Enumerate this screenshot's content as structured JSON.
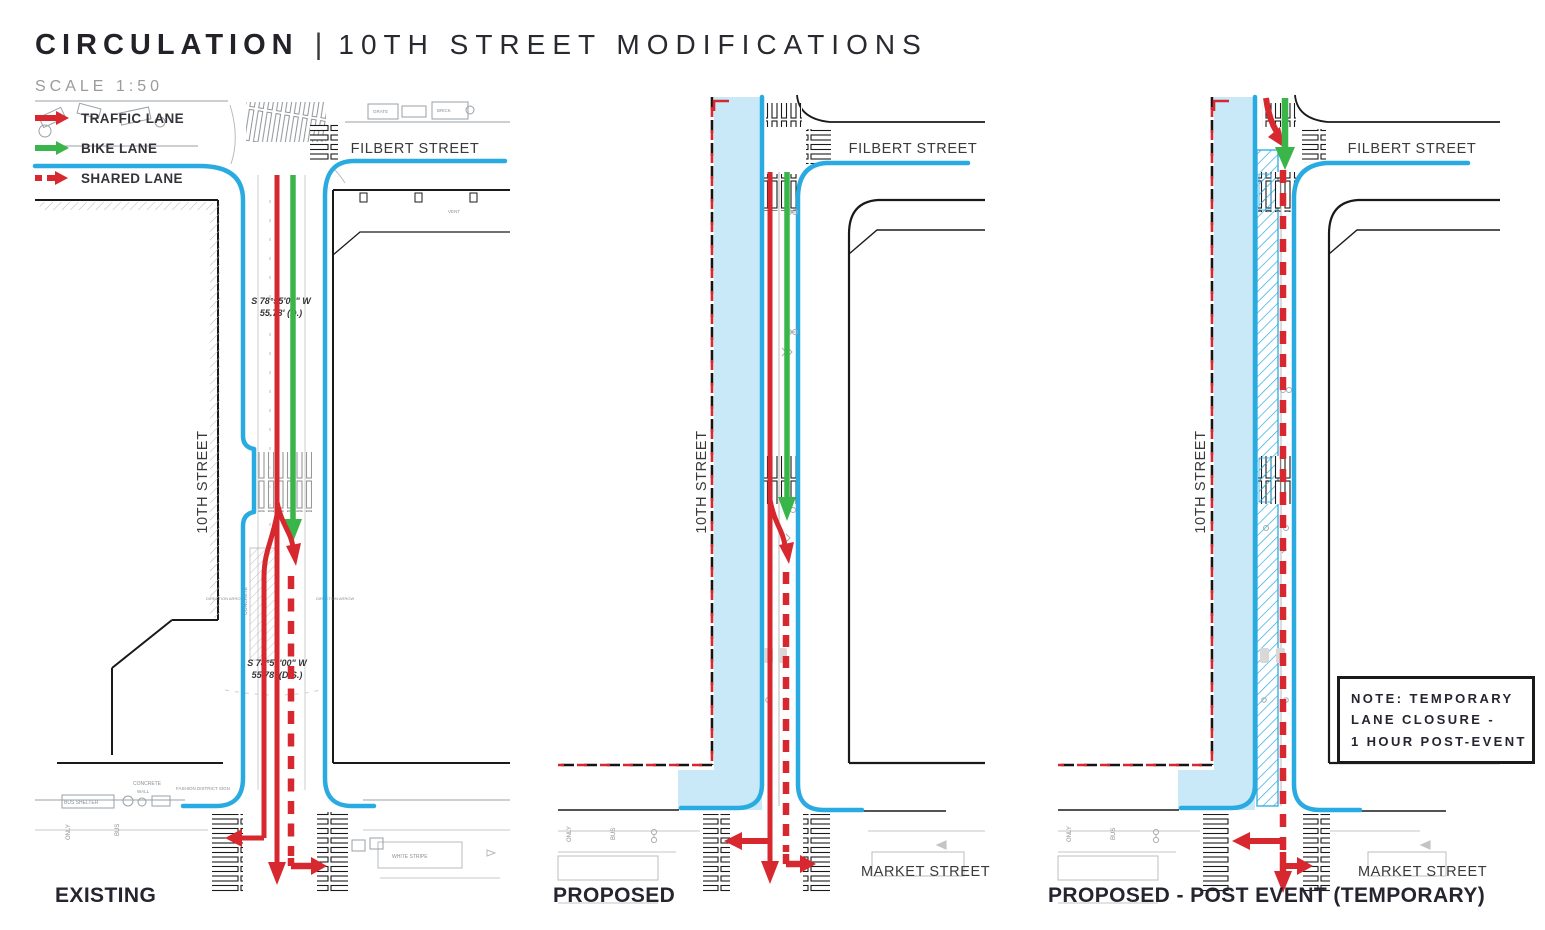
{
  "header": {
    "title": "CIRCULATION",
    "divider": "|",
    "subtitle": "10TH STREET MODIFICATIONS",
    "scale": "SCALE 1:50"
  },
  "legend": {
    "traffic": "TRAFFIC LANE",
    "bike": "BIKE LANE",
    "shared": "SHARED LANE"
  },
  "colors": {
    "traffic_red": "#d7282f",
    "bike_green": "#3ab54a",
    "curb_blue": "#29abe2",
    "plaza_blue": "#c9e9f8",
    "ink": "#272430",
    "label_gray": "#3b3a3a",
    "faint_gray": "#9b9b9b"
  },
  "panels": [
    {
      "caption": "EXISTING",
      "filbert": "FILBERT STREET",
      "tenth": "10TH STREET",
      "survey_a1": "S 78°55'00\" W",
      "survey_a2": "55.78' (D.)",
      "survey_b1": "S 78°55'00\" W",
      "survey_b2": "55.78' (D.S.)",
      "micro": {
        "grate": "GRATE",
        "brick": "BRICK",
        "vent": "VENT",
        "concrete": "CONCRETE",
        "concrete2": "CONCRETE",
        "dir_arrow_l": "DIRECTION ARROW",
        "dir_arrow_r": "DIRECTION ARROW",
        "bus_shelter": "BUS SHELTER",
        "wall": "WALL",
        "fashion_sign": "FASHION DISTRICT SIGN",
        "only": "ONLY",
        "bus": "BUS",
        "white_stripe": "WHITE STRIPE"
      }
    },
    {
      "caption": "PROPOSED",
      "filbert": "FILBERT STREET",
      "tenth": "10TH STREET",
      "market": "MARKET STREET",
      "micro": {
        "only": "ONLY",
        "bus": "BUS"
      }
    },
    {
      "caption": "PROPOSED - POST EVENT (TEMPORARY)",
      "filbert": "FILBERT STREET",
      "tenth": "10TH STREET",
      "market": "MARKET STREET",
      "micro": {
        "only": "ONLY",
        "bus": "BUS"
      },
      "note_line1": "NOTE: TEMPORARY",
      "note_line2": "LANE CLOSURE -",
      "note_line3": "1 HOUR POST-EVENT"
    }
  ]
}
